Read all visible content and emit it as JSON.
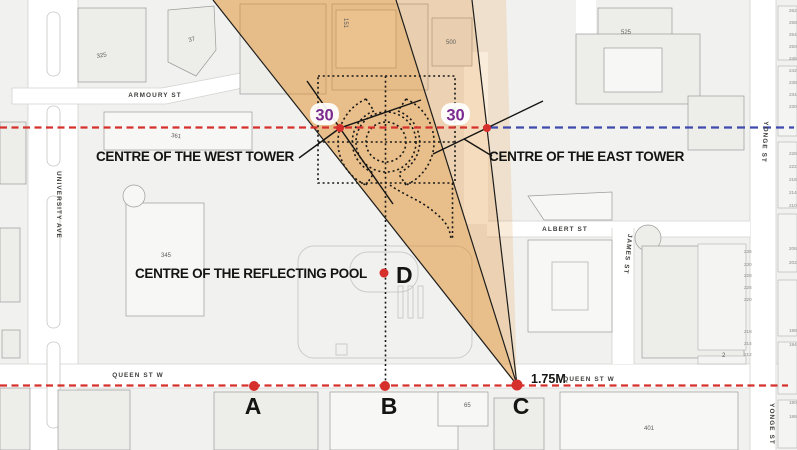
{
  "title_labels": {
    "west_tower": "CENTRE OF THE WEST TOWER",
    "east_tower": "CENTRE OF THE EAST TOWER",
    "reflecting_pool": "CENTRE OF THE REFLECTING POOL",
    "angle_west": "30",
    "angle_east": "30",
    "distance": "1.75M"
  },
  "points": {
    "a": "A",
    "b": "B",
    "c": "C",
    "d": "D"
  },
  "colors": {
    "cone_orange": "#EFBB7C",
    "cone_light": "#F4D6B0",
    "cone_pale": "#F9E8D2",
    "dashed_red": "#D6302C",
    "dashed_blue": "#3F49AE",
    "angle_purple": "#7B2B90",
    "dot_red": "#D6302C",
    "map_block": "#F1F1EF",
    "building_fill": "#EDEDEA",
    "road_white": "#FFFFFF"
  },
  "map": {
    "street_labels": [
      {
        "text": "ARMOURY ST",
        "x": 155,
        "y": 97,
        "anchor": "middle"
      },
      {
        "text": "QUEEN ST W",
        "x": 138,
        "y": 377,
        "anchor": "middle"
      },
      {
        "text": "QUEEN ST W",
        "x": 589,
        "y": 381,
        "anchor": "middle"
      },
      {
        "text": "ALBERT ST",
        "x": 565,
        "y": 231,
        "anchor": "middle"
      },
      {
        "text": "UNIVERSITY AVE",
        "x": 57,
        "y": 205,
        "anchor": "middle",
        "rotate": 90
      },
      {
        "text": "YONGE ST",
        "x": 763,
        "y": 142,
        "anchor": "middle",
        "rotate": 93
      },
      {
        "text": "YONGE ST",
        "x": 770,
        "y": 424,
        "anchor": "middle",
        "rotate": 90
      },
      {
        "text": "JAMES ST",
        "x": 626,
        "y": 254,
        "anchor": "middle",
        "rotate": 96
      }
    ],
    "building_numbers": [
      {
        "text": "325",
        "x": 97,
        "y": 58,
        "rotate": -10
      },
      {
        "text": "37",
        "x": 189,
        "y": 42,
        "rotate": -15
      },
      {
        "text": "361",
        "x": 171,
        "y": 137,
        "rotate": 8
      },
      {
        "text": "345",
        "x": 161,
        "y": 257
      },
      {
        "text": "151",
        "x": 344,
        "y": 18,
        "rotate": 90
      },
      {
        "text": "500",
        "x": 446,
        "y": 44
      },
      {
        "text": "525",
        "x": 621,
        "y": 34
      },
      {
        "text": "65",
        "x": 464,
        "y": 407
      },
      {
        "text": "401",
        "x": 644,
        "y": 430
      },
      {
        "text": "2",
        "x": 722,
        "y": 357
      }
    ],
    "addresses": [
      {
        "text": "236",
        "x": 744,
        "y": 253
      },
      {
        "text": "230",
        "x": 744,
        "y": 266
      },
      {
        "text": "228",
        "x": 744,
        "y": 277
      },
      {
        "text": "226",
        "x": 744,
        "y": 289
      },
      {
        "text": "220",
        "x": 744,
        "y": 301
      },
      {
        "text": "218",
        "x": 744,
        "y": 333
      },
      {
        "text": "214",
        "x": 744,
        "y": 345
      },
      {
        "text": "212",
        "x": 744,
        "y": 356
      },
      {
        "text": "262",
        "x": 789,
        "y": 12
      },
      {
        "text": "258",
        "x": 789,
        "y": 24
      },
      {
        "text": "254",
        "x": 789,
        "y": 36
      },
      {
        "text": "250",
        "x": 789,
        "y": 48
      },
      {
        "text": "246",
        "x": 789,
        "y": 60
      },
      {
        "text": "242",
        "x": 789,
        "y": 72
      },
      {
        "text": "238",
        "x": 789,
        "y": 84
      },
      {
        "text": "234",
        "x": 789,
        "y": 96
      },
      {
        "text": "230",
        "x": 789,
        "y": 108
      },
      {
        "text": "226",
        "x": 789,
        "y": 155
      },
      {
        "text": "222",
        "x": 789,
        "y": 168
      },
      {
        "text": "218",
        "x": 789,
        "y": 181
      },
      {
        "text": "214",
        "x": 789,
        "y": 194
      },
      {
        "text": "210",
        "x": 789,
        "y": 207
      },
      {
        "text": "206",
        "x": 789,
        "y": 250
      },
      {
        "text": "202",
        "x": 789,
        "y": 264
      },
      {
        "text": "198",
        "x": 789,
        "y": 332
      },
      {
        "text": "194",
        "x": 789,
        "y": 346
      },
      {
        "text": "190",
        "x": 789,
        "y": 404
      },
      {
        "text": "186",
        "x": 789,
        "y": 418
      }
    ]
  }
}
